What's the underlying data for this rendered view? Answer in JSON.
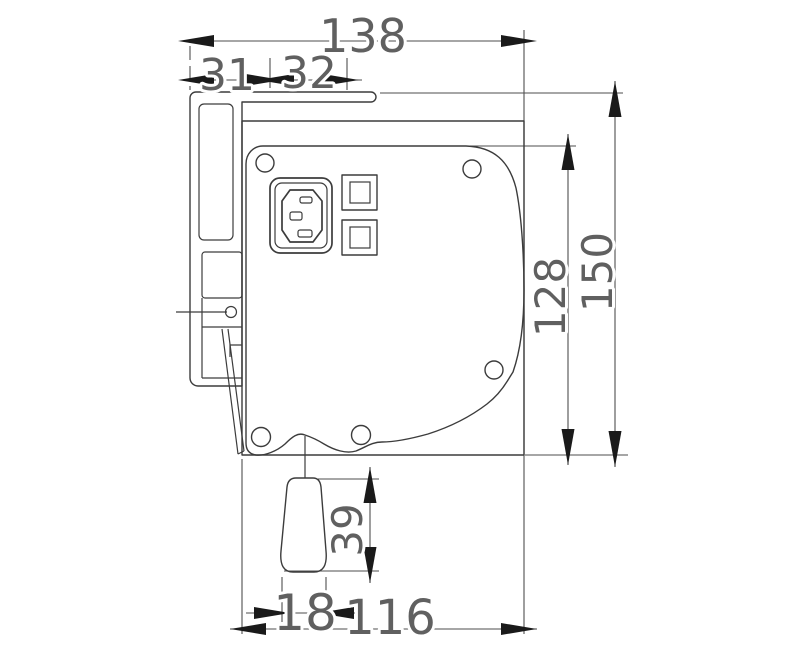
{
  "drawing": {
    "dimensions": {
      "total_width": "138",
      "bracket_offset": "31",
      "bracket_depth": "32",
      "face_height": "128",
      "overall_height": "150",
      "handle_length": "39",
      "handle_tip_width": "18",
      "body_width": "116"
    },
    "colors": {
      "outline": "#3c3c3c",
      "dimension_line": "#4e4e4e",
      "arrow": "#1a1a1a",
      "label_text": "#606060",
      "background": "#ffffff"
    }
  }
}
